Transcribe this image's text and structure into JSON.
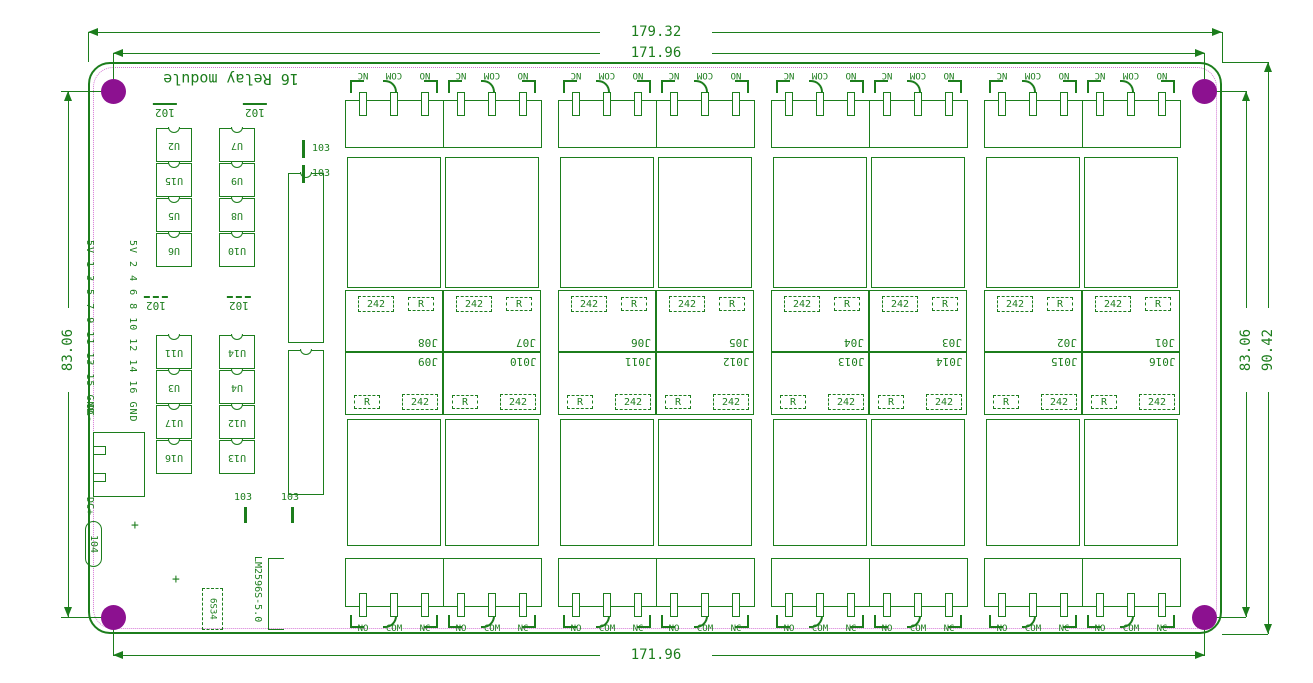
{
  "drawing": {
    "title": "16 Relay module",
    "dimensions": {
      "top_outer": "179.32",
      "top_inner": "171.96",
      "bottom": "171.96",
      "left": "83.06",
      "right_inner": "83.06",
      "right_outer": "90.42"
    },
    "colors": {
      "line_green": "#1c7d1c",
      "outline_magenta": "#d478d4",
      "hole_purple": "#8c1190",
      "background": "#ffffff"
    }
  },
  "terminals": {
    "top_labels": [
      "NC",
      "COM",
      "NO"
    ],
    "bottom_labels": [
      "NO",
      "COM",
      "NC"
    ]
  },
  "relays": {
    "top_jumpers": [
      "J08",
      "J07",
      "J06",
      "J05",
      "J04",
      "J03",
      "J02",
      "J01"
    ],
    "bottom_jumpers": [
      "J09",
      "J010",
      "J011",
      "J012",
      "J013",
      "J014",
      "J015",
      "J016"
    ],
    "part": "242",
    "resistor": "R"
  },
  "ics": {
    "top_columns": [
      {
        "label": "102",
        "refs": [
          "U2",
          "U15",
          "U5",
          "U6"
        ]
      },
      {
        "label": "102",
        "refs": [
          "U7",
          "U9",
          "U8",
          "U10"
        ]
      }
    ],
    "lower_columns": [
      {
        "label": "102",
        "refs": [
          "U11",
          "U3",
          "U17",
          "U16"
        ]
      },
      {
        "label": "102",
        "refs": [
          "U14",
          "U4",
          "U12",
          "U13"
        ]
      }
    ],
    "dip_top_labels": [
      "103",
      "103"
    ],
    "dip_bottom_labels": [
      "103",
      "103"
    ]
  },
  "header": {
    "row1": "5V 1 3 5 7 9 11 13 15 GND",
    "row2": "5V 2 4 6 8 10 12 14 16 GND"
  },
  "power": {
    "dc_minus": "DC-",
    "dc_plus": "DC+",
    "port": "104",
    "regulator": "LM2596S-5.0",
    "diode": "6S34",
    "plus": "+"
  }
}
